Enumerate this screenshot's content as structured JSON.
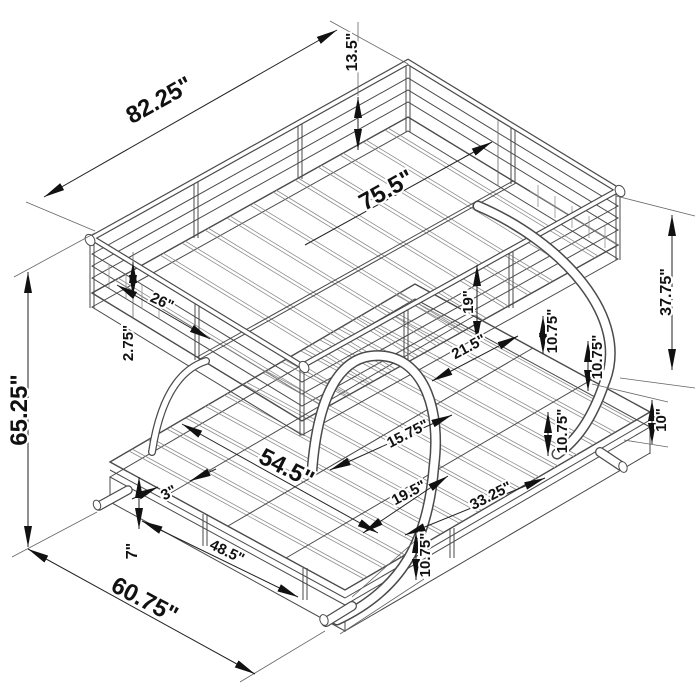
{
  "meta": {
    "subject": "Isometric wireframe dimension diagram of a twin-over-futon metal bunk bed with C-shaped legs",
    "units": "inches",
    "background_color": "#ffffff",
    "linework_color": "#4a4a4a",
    "dimension_text_color": "#111111"
  },
  "dims": [
    {
      "id": "overall-length-top",
      "label": "82.25\"",
      "value": 82.25,
      "axis": "length"
    },
    {
      "id": "guardrail-height",
      "label": "13.5\"",
      "value": 13.5,
      "axis": "vertical"
    },
    {
      "id": "top-sleep-length",
      "label": "75.5\"",
      "value": 75.5,
      "axis": "length"
    },
    {
      "id": "overall-height",
      "label": "65.25\"",
      "value": 65.25,
      "axis": "vertical"
    },
    {
      "id": "head-rail-section",
      "label": "26\"",
      "value": 26,
      "axis": "width"
    },
    {
      "id": "head-rail-gap",
      "label": "2.75\"",
      "value": 2.75,
      "axis": "vertical"
    },
    {
      "id": "bunk-to-deck-clearance",
      "label": "19\"",
      "value": 19,
      "axis": "vertical"
    },
    {
      "id": "mid-section-length",
      "label": "21.5\"",
      "value": 21.5,
      "axis": "length"
    },
    {
      "id": "leg-clearance-a",
      "label": "10.75\"",
      "value": 10.75,
      "axis": "vertical"
    },
    {
      "id": "leg-clearance-b",
      "label": "10.75\"",
      "value": 10.75,
      "axis": "vertical"
    },
    {
      "id": "underbunk-height",
      "label": "37.75\"",
      "value": 37.75,
      "axis": "vertical"
    },
    {
      "id": "deck-height-right",
      "label": "10\"",
      "value": 10,
      "axis": "vertical"
    },
    {
      "id": "futon-depth",
      "label": "54.5\"",
      "value": 54.5,
      "axis": "width"
    },
    {
      "id": "futon-section-a",
      "label": "15.75\"",
      "value": 15.75,
      "axis": "length"
    },
    {
      "id": "futon-section-b",
      "label": "19.5\"",
      "value": 19.5,
      "axis": "length"
    },
    {
      "id": "futon-front-section",
      "label": "33.25\"",
      "value": 33.25,
      "axis": "length"
    },
    {
      "id": "slat-spacing",
      "label": "3\"",
      "value": 3,
      "axis": "length"
    },
    {
      "id": "base-rail-width",
      "label": "48.5\"",
      "value": 48.5,
      "axis": "width"
    },
    {
      "id": "base-height-left",
      "label": "7\"",
      "value": 7,
      "axis": "vertical"
    },
    {
      "id": "leg-clearance-c",
      "label": "10.75\"",
      "value": 10.75,
      "axis": "vertical"
    },
    {
      "id": "overall-depth",
      "label": "60.75\"",
      "value": 60.75,
      "axis": "width"
    },
    {
      "id": "front-deck-height",
      "label": "10.75\"",
      "value": 10.75,
      "axis": "vertical"
    }
  ]
}
